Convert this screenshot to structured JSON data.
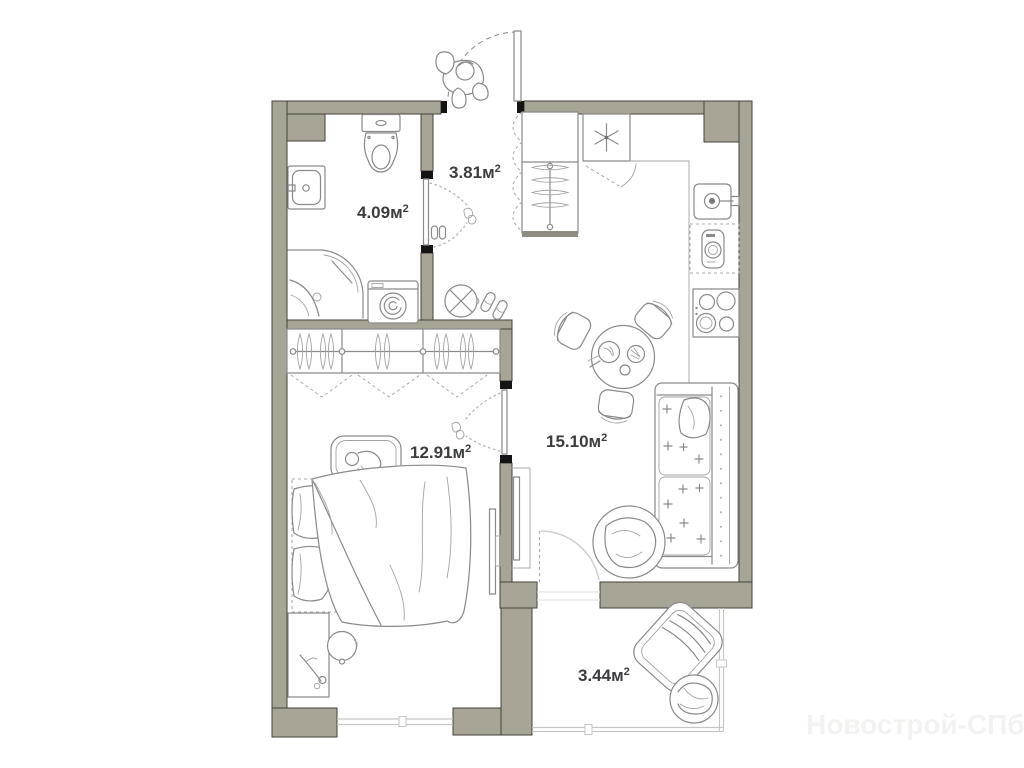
{
  "watermark": "Новострой-СПб",
  "rooms": {
    "bathroom": {
      "value": "4.09м",
      "sup": "2"
    },
    "hallway": {
      "value": "3.81м",
      "sup": "2"
    },
    "bedroom": {
      "value": "12.91м",
      "sup": "2"
    },
    "living_kitchen": {
      "value": "15.10м",
      "sup": "2"
    },
    "balcony": {
      "value": "3.44м",
      "sup": "2"
    }
  },
  "colors": {
    "wall": "#a8a496",
    "wall_outline": "#43423b",
    "door_jamb": "#141414",
    "furniture_line": "#8a8a8a",
    "window_line": "#c6c6c3",
    "label_text": "#3c3d3f",
    "watermark_text": "#f2f2f1",
    "background": "#ffffff"
  },
  "icons": [
    "entrance-door",
    "person",
    "toilet",
    "bathroom-sink",
    "shower",
    "washing-machine",
    "hall-closet",
    "stool",
    "slippers",
    "refrigerator",
    "kitchen-counter",
    "kitchen-sink",
    "dishwasher",
    "stove",
    "dining-table",
    "chair",
    "sofa",
    "round-armchair",
    "tv",
    "wardrobe",
    "crib",
    "double-bed",
    "nightstand",
    "side-table",
    "lounge-chair",
    "pouf",
    "balcony-door",
    "window"
  ]
}
